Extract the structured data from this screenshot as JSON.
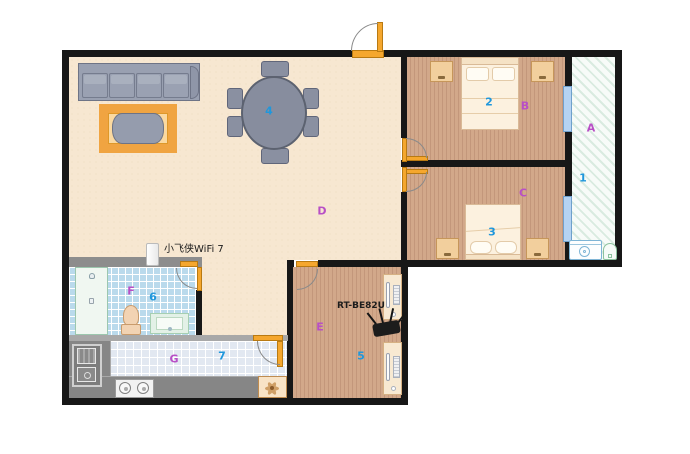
{
  "title": "apartment-floor-plan",
  "colors": {
    "wall": "#171717",
    "bath_wall": "#8d8d8d",
    "door": "#f5a72e",
    "window": "#b5d3f2",
    "room_letter": "#b84fc6",
    "room_number": "#1f97dc",
    "wood_floor": "#d2a88a",
    "living_floor": "#f7e7d1",
    "bath_tile": "#badaec",
    "kitchen_tile": "#e2e8f1",
    "counter": "#868686",
    "balcony_hatch": "#d9ebe0",
    "router_body": "#1c1c1c"
  },
  "rooms": [
    {
      "id": "balcony",
      "letter": "A",
      "number": "1"
    },
    {
      "id": "bedroom-top",
      "letter": "B",
      "number": "2"
    },
    {
      "id": "bedroom-bottom",
      "letter": "C",
      "number": "3"
    },
    {
      "id": "living-dining",
      "letter": "D",
      "number": "4"
    },
    {
      "id": "study",
      "letter": "E",
      "number": "5"
    },
    {
      "id": "bathroom",
      "letter": "F",
      "number": "6"
    },
    {
      "id": "kitchen",
      "letter": "G",
      "number": "7"
    }
  ],
  "devices": {
    "mesh_node": "小飞侠WiFi 7",
    "router": "RT-BE82U"
  }
}
